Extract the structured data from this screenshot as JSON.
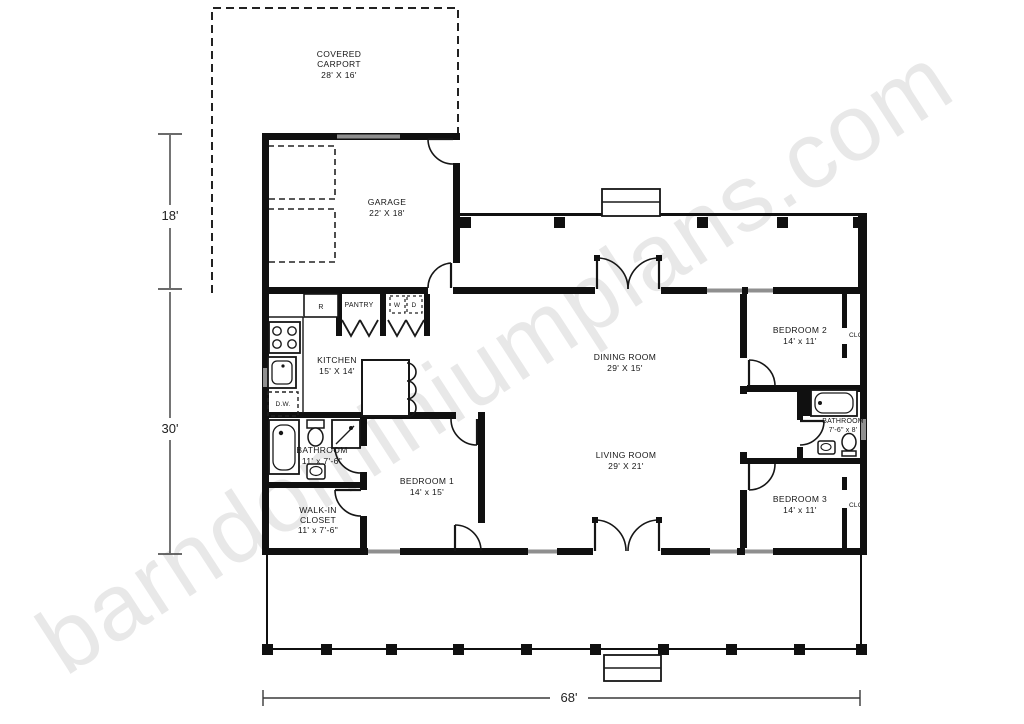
{
  "watermark": {
    "text": "barndominiumplans.com"
  },
  "rooms": {
    "carport": {
      "line1": "COVERED",
      "line2": "CARPORT",
      "dims": "28' X 16'"
    },
    "garage": {
      "name": "GARAGE",
      "dims": "22' X 18'"
    },
    "kitchen": {
      "name": "KITCHEN",
      "dims": "15' X 14'"
    },
    "pantry": {
      "name": "PANTRY"
    },
    "dining": {
      "name": "DINING ROOM",
      "dims": "29' X 15'"
    },
    "living": {
      "name": "LIVING ROOM",
      "dims": "29' X 21'"
    },
    "bedroom1": {
      "name": "BEDROOM 1",
      "dims": "14' x 15'"
    },
    "bedroom2": {
      "name": "BEDROOM 2",
      "dims": "14' x 11'"
    },
    "bedroom3": {
      "name": "BEDROOM 3",
      "dims": "14' x 11'"
    },
    "bathroom_master": {
      "name": "BATHROOM",
      "dims": "11' x 7'-6\""
    },
    "bathroom2": {
      "name": "BATHROOM",
      "dims": "7'-6\" x 8'"
    },
    "walkin_closet": {
      "line1": "WALK-IN",
      "line2": "CLOSET",
      "dims": "11' x 7'-6\""
    }
  },
  "fixtures": {
    "refrigerator": "R",
    "washer": "W",
    "dryer": "D",
    "dishwasher": "D.W.",
    "closet_bed2": "CLO",
    "closet_bed3": "CLO"
  },
  "dimensions": {
    "garage_depth": "18'",
    "main_depth": "30'",
    "overall_width": "68'"
  },
  "colors": {
    "wall": "#101010",
    "window": "#8f8f8f",
    "watermark": "#e8e8e8"
  }
}
